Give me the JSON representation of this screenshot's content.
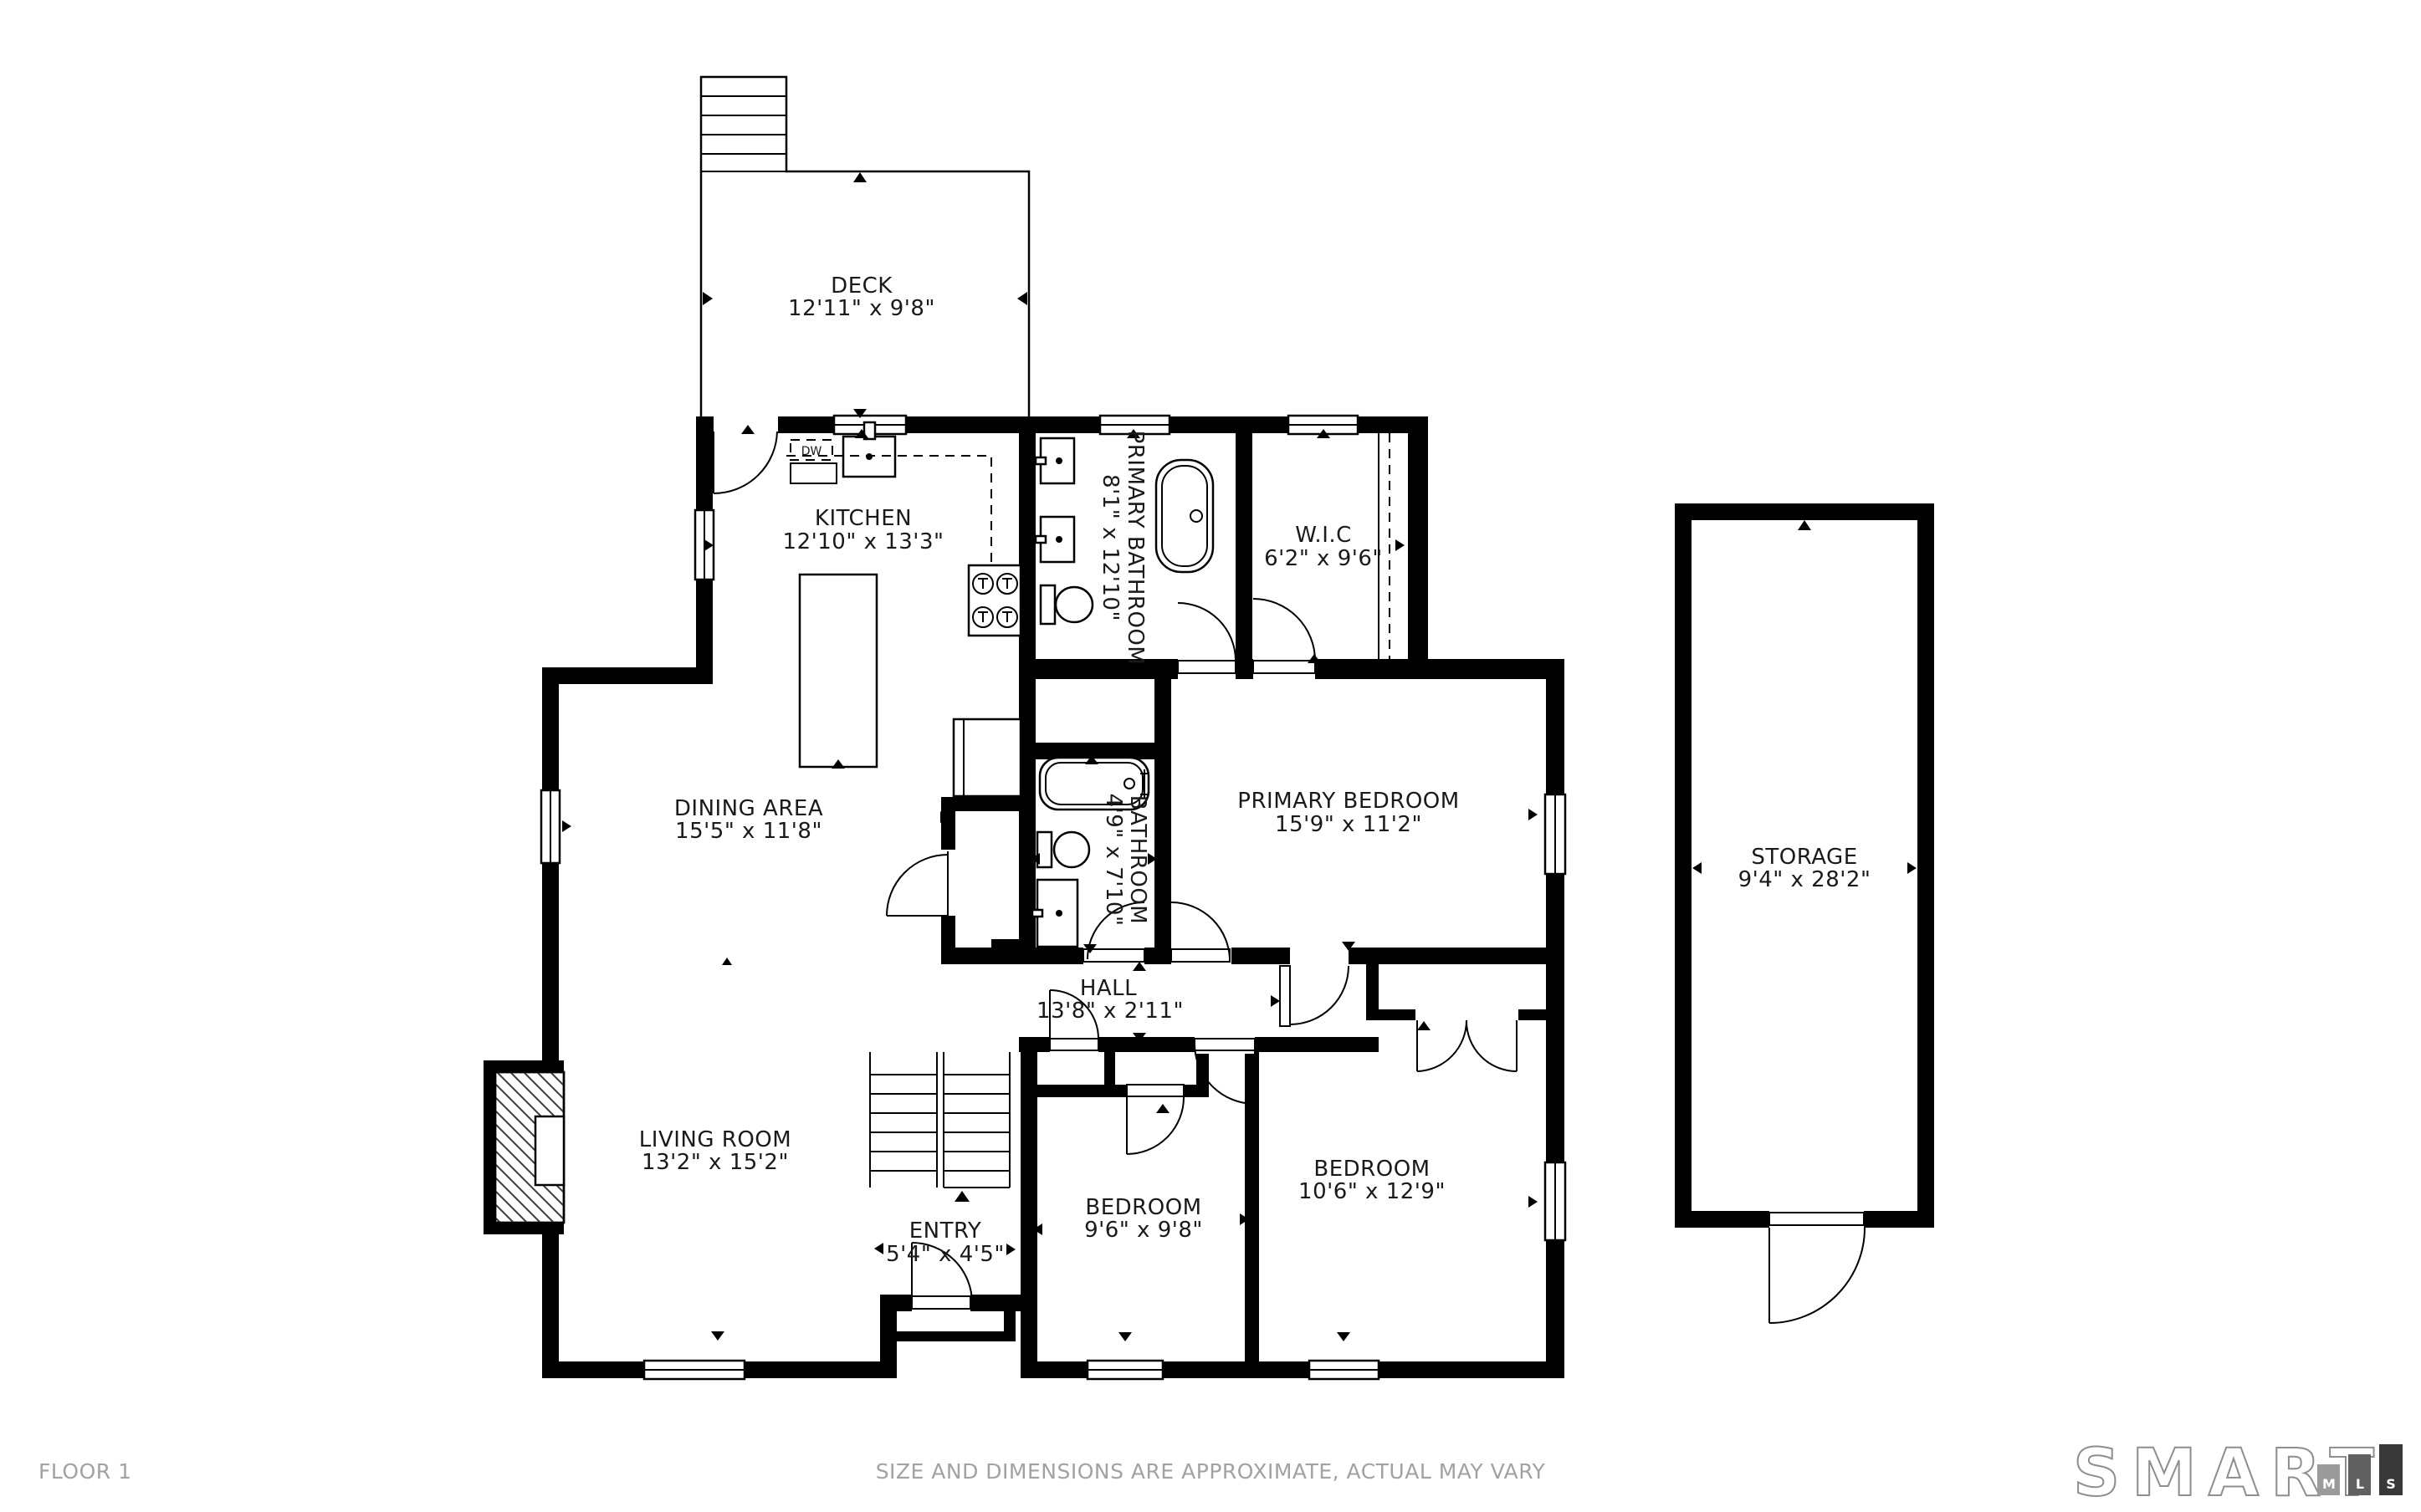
{
  "footer": {
    "floor_label": "FLOOR 1",
    "disclaimer": "SIZE AND DIMENSIONS ARE APPROXIMATE, ACTUAL MAY VARY"
  },
  "brand": {
    "word": "SMART",
    "blocks": [
      {
        "letter": "M",
        "color": "#9b9b9b"
      },
      {
        "letter": "L",
        "color": "#606060"
      },
      {
        "letter": "S",
        "color": "#383838"
      }
    ]
  },
  "fixtures": {
    "dishwasher_label": "DW"
  },
  "rooms": {
    "deck": {
      "name": "DECK",
      "dims": "12'11\" x 9'8\""
    },
    "kitchen": {
      "name": "KITCHEN",
      "dims": "12'10\" x 13'3\""
    },
    "primary_bathroom": {
      "name": "PRIMARY BATHROOM",
      "dims": "8'1\" x 12'10\""
    },
    "wic": {
      "name": "W.I.C",
      "dims": "6'2\" x 9'6\""
    },
    "primary_bedroom": {
      "name": "PRIMARY BEDROOM",
      "dims": "15'9\" x 11'2\""
    },
    "dining": {
      "name": "DINING AREA",
      "dims": "15'5\" x 11'8\""
    },
    "bathroom": {
      "name": "BATHROOM",
      "dims": "4'9\" x 7'10\""
    },
    "hall": {
      "name": "HALL",
      "dims": "13'8\" x 2'11\""
    },
    "living": {
      "name": "LIVING ROOM",
      "dims": "13'2\" x 15'2\""
    },
    "entry": {
      "name": "ENTRY",
      "dims": "5'4\" x 4'5\""
    },
    "bedroom1": {
      "name": "BEDROOM",
      "dims": "9'6\" x 9'8\""
    },
    "bedroom2": {
      "name": "BEDROOM",
      "dims": "10'6\" x 12'9\""
    },
    "storage": {
      "name": "STORAGE",
      "dims": "9'4\" x 28'2\""
    }
  },
  "colors": {
    "wall": "#000000",
    "label": "#1a1a1a",
    "muted_text": "#a2a2a2",
    "brand_outline": "#8e8e8e"
  }
}
